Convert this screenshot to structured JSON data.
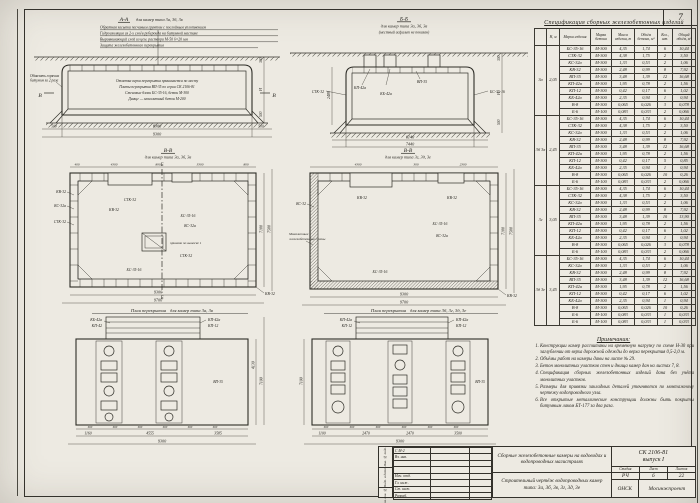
{
  "sheet": {
    "corner_number": "7"
  },
  "section_aa": {
    "title": "А-А",
    "subtitle": "для камер типа 3а, 3б, 3в",
    "top_notes": [
      "Обратная засыпка песчаным грунтом с послойным уплотнением",
      "Гидроизоляция из 2-х слоёв рубероида на битумной мастике",
      "Выравнивающий слой из цем. раствора М-50  δ=20 мм",
      "Защита железобетонного перекрытия"
    ],
    "inner_notes": [
      "Отметка верха перекрытия принимается по месту",
      "Плиты перекрытия ВП-35 по серии СК 2106-81",
      "Стеновые блоки БС-35-16, бетон М-300",
      "Днище — монолитный бетон М-200"
    ],
    "left_label_1": "Обмазать горячим",
    "left_label_2": "битумом за 2 раза",
    "marker": "В",
    "dims": {
      "inner": "8300",
      "end_left": "500",
      "end_right": "500",
      "total": "9300",
      "right_top": "300",
      "right_mid": "Н",
      "right_bot": "500"
    }
  },
  "section_bb": {
    "title": "Б-Б",
    "subtitle": "для камер типа 3а, 3б, 3в",
    "note": "(местный асфальт не показан)",
    "labels": [
      "КП-42а",
      "КБ-42а",
      "ВП-35",
      "БС-35-16",
      "СТК-32"
    ],
    "dims": {
      "left": "2480",
      "inner": "6140",
      "total": "7440",
      "right_top": "300",
      "right_mid": "Н",
      "right_bot": "500"
    }
  },
  "plan_left": {
    "title": "В-В",
    "subtitle": "для камер типа 3а, 3б, 3в",
    "top_dims": [
      "400",
      "4300",
      "890",
      "3300",
      "800"
    ],
    "outside_left": [
      "КВ-32",
      "КС-32а",
      "СТК-32"
    ],
    "inside": [
      "СТК-32",
      "КВ-32",
      "БС-35-16",
      "КС-32а",
      "СТК-32",
      "БС-35-16"
    ],
    "pit_label": "приямок по выноске 1",
    "corner_label": "КВ-32",
    "marker": "Б",
    "bottom_dims": [
      "9300",
      "9700"
    ],
    "right_dims": [
      "7100",
      "7500"
    ]
  },
  "plan_right": {
    "title": "В-В",
    "subtitle": "для камер типа 3г, 3д, 3е",
    "top_dims": [
      "4300",
      "300",
      "2300"
    ],
    "mono_1": "Монолитные",
    "mono_2": "железобетонные стены",
    "outside_left": "КС-32",
    "inside": [
      "КВ-32",
      "КВ-32",
      "БС-35-16",
      "КС-32а",
      "БС-35-16"
    ],
    "corner_label": "КВ-32",
    "bottom_dims": [
      "9300",
      "9700"
    ],
    "right_dims": [
      "7100",
      "7500"
    ]
  },
  "slab_left": {
    "title": "План перекрытия",
    "subtitle": "для камер типа 3а, 3в",
    "labels_tl": [
      "КБ-42а",
      "КП-42"
    ],
    "labels_tr": [
      "КП-42а",
      "КП-12"
    ],
    "inside_label": "ВП-35",
    "spacing": "600",
    "bottom_dims": [
      "1160",
      "4555",
      "3585"
    ],
    "total": "9300",
    "right_dims": [
      "4130",
      "7100"
    ]
  },
  "slab_right": {
    "title": "План перекрытия",
    "subtitle": "для камер типа 3б, 3г, 3д, 3е",
    "labels_tl": [
      "КП-42а",
      "КП-12"
    ],
    "labels_tr": [
      "КП-42а",
      "КП-12"
    ],
    "inside_label": "ВП-35",
    "spacing": "600",
    "bottom_dims": [
      "1100",
      "2470",
      "2470",
      "3500"
    ],
    "total": "9300",
    "left_dim": "7100"
  },
  "spec_table": {
    "title": "Спецификация сборных железобетонных изделий",
    "headers": [
      "",
      "Н, м",
      "Марка изделия",
      "Марка бетона",
      "Масса изделия, т",
      "Объём бетона, м³",
      "Кол., шт.",
      "Общий объём, м³"
    ],
    "groups": [
      {
        "type": "3а",
        "h": "2,05",
        "rows": [
          [
            "БС-35-16",
            "М-300",
            "4,35",
            "1,74",
            "6",
            "10,44"
          ],
          [
            "СТК-32",
            "М-300",
            "4,38",
            "1,75",
            "2",
            "3,50"
          ],
          [
            "КС-32а",
            "М-300",
            "1,33",
            "0,53",
            "2",
            "1,06"
          ],
          [
            "КВ-32",
            "М-300",
            "2,48",
            "0,99",
            "8",
            "7,92"
          ],
          [
            "ВП-35",
            "М-300",
            "3,48",
            "1,39",
            "12",
            "16,68"
          ],
          [
            "КП-42а",
            "М-300",
            "1,95",
            "0,78",
            "2",
            "1,56"
          ],
          [
            "КП-12",
            "М-300",
            "0,42",
            "0,17",
            "6",
            "1,02"
          ],
          [
            "КБ-42а",
            "М-300",
            "2,35",
            "0,94",
            "1",
            "0,94"
          ],
          [
            "В-8",
            "М-300",
            "0,065",
            "0,026",
            "3",
            "0,078"
          ],
          [
            "Б-6",
            "М-100",
            "0,083",
            "0,033",
            "2",
            "0,066"
          ]
        ]
      },
      {
        "type": "3б 3в",
        "h": "2,45",
        "rows": [
          [
            "БС-35-16",
            "М-300",
            "4,35",
            "1,74",
            "6",
            "10,44"
          ],
          [
            "СТК-32",
            "М-300",
            "4,38",
            "1,75",
            "2",
            "3,50"
          ],
          [
            "КС-32а",
            "М-300",
            "1,33",
            "0,53",
            "2",
            "1,06"
          ],
          [
            "КВ-32",
            "М-300",
            "2,48",
            "0,99",
            "8",
            "7,92"
          ],
          [
            "ВП-35",
            "М-300",
            "3,48",
            "1,39",
            "12",
            "16,68"
          ],
          [
            "КП-42а",
            "М-300",
            "1,95",
            "0,78",
            "2",
            "1,56"
          ],
          [
            "КП-12",
            "М-300",
            "0,42",
            "0,17",
            "5",
            "0,85"
          ],
          [
            "КБ-42а",
            "М-300",
            "2,35",
            "0,94",
            "1",
            "0,94"
          ],
          [
            "В-8",
            "М-300",
            "0,065",
            "0,026",
            "10",
            "0,26"
          ],
          [
            "Б-6",
            "М-100",
            "0,083",
            "0,033",
            "2",
            "0,066"
          ]
        ]
      },
      {
        "type": "3г",
        "h": "3,05",
        "rows": [
          [
            "БС-35-16",
            "М-300",
            "4,35",
            "1,74",
            "6",
            "10,44"
          ],
          [
            "СТК-32",
            "М-300",
            "4,38",
            "1,75",
            "2",
            "3,50"
          ],
          [
            "КС-32а",
            "М-300",
            "1,33",
            "0,53",
            "2",
            "1,06"
          ],
          [
            "КВ-32",
            "М-300",
            "2,48",
            "0,99",
            "8",
            "7,92"
          ],
          [
            "ВП-35",
            "М-300",
            "3,48",
            "1,39",
            "10",
            "13,90"
          ],
          [
            "КП-42а",
            "М-300",
            "1,95",
            "0,78",
            "2",
            "1,56"
          ],
          [
            "КП-12",
            "М-300",
            "0,42",
            "0,17",
            "6",
            "1,02"
          ],
          [
            "КБ-42а",
            "М-300",
            "2,35",
            "0,94",
            "1",
            "0,94"
          ],
          [
            "В-8",
            "М-300",
            "0,065",
            "0,026",
            "3",
            "0,078"
          ],
          [
            "Б-6",
            "М-100",
            "0,083",
            "0,033",
            "2",
            "0,066"
          ]
        ]
      },
      {
        "type": "3д 3е",
        "h": "3,45",
        "rows": [
          [
            "БС-35-16",
            "М-300",
            "4,35",
            "1,74",
            "6",
            "10,44"
          ],
          [
            "КС-32а",
            "М-300",
            "1,33",
            "0,53",
            "2",
            "1,06"
          ],
          [
            "КВ-32",
            "М-300",
            "2,48",
            "0,99",
            "8",
            "7,92"
          ],
          [
            "ВП-35",
            "М-300",
            "3,48",
            "1,39",
            "12",
            "16,68"
          ],
          [
            "КП-42а",
            "М-300",
            "1,95",
            "0,78",
            "2",
            "1,56"
          ],
          [
            "КП-12",
            "М-300",
            "0,42",
            "0,17",
            "6",
            "1,02"
          ],
          [
            "КБ-42а",
            "М-300",
            "2,35",
            "0,94",
            "1",
            "0,94"
          ],
          [
            "В-8",
            "М-300",
            "0,065",
            "0,026",
            "10",
            "0,26"
          ],
          [
            "Б-6",
            "М-100",
            "0,083",
            "0,033",
            "1",
            "0,033"
          ],
          [
            "Б-6",
            "М-100",
            "0,083",
            "0,033",
            "1",
            "0,033"
          ]
        ]
      }
    ]
  },
  "notes": {
    "title": "Примечания:",
    "items": [
      "Конструкции камер рассчитаны на временную нагрузку по схеме Н-30 при заглублении от верха дорожной одежды до верха перекрытия 0,5-2,0 м.",
      "Объёмы работ на камеры даны на листе № 29.",
      "Бетон монолитных участков стен и днища камер дан на листах 7, 8.",
      "Спецификация сборных железобетонных изделий дана без учёта монолитных участков.",
      "Размеры для привязки закладных деталей уточняются по монтажному чертежу водопроводного узла.",
      "Все открытые металлические конструкции должны быть покрыты битумным лаком БТ-177 за два раза."
    ]
  },
  "stamp": {
    "side_labels": [
      "Инв. № подл.",
      "Подп. и дата",
      "Взам. инв. №"
    ],
    "sig_rows": [
      {
        "role": "С М-2"
      },
      {
        "role": "Вз. инв."
      },
      {
        "role": ""
      },
      {
        "role": ""
      },
      {
        "role": "Нач. отд."
      },
      {
        "role": "Гл. инж."
      },
      {
        "role": "Ст. инж."
      },
      {
        "role": "Разраб."
      }
    ],
    "project_title": "Сборные железобетонные камеры на водоводах и водопроводных магистралях",
    "drawing_title": "Строительный чертёж водопроводных камер типа: 3а, 3б, 3в, 3г, 3д, 3е",
    "code": "СК 2106-81",
    "issue": "выпуск I",
    "stage_label": "Стадия",
    "list_label": "Лист",
    "lists_label": "Листов",
    "stage": "РЧ",
    "list": "6",
    "lists": "22",
    "org_left": "ОНСК",
    "org_right": "Мосинжпроект"
  }
}
